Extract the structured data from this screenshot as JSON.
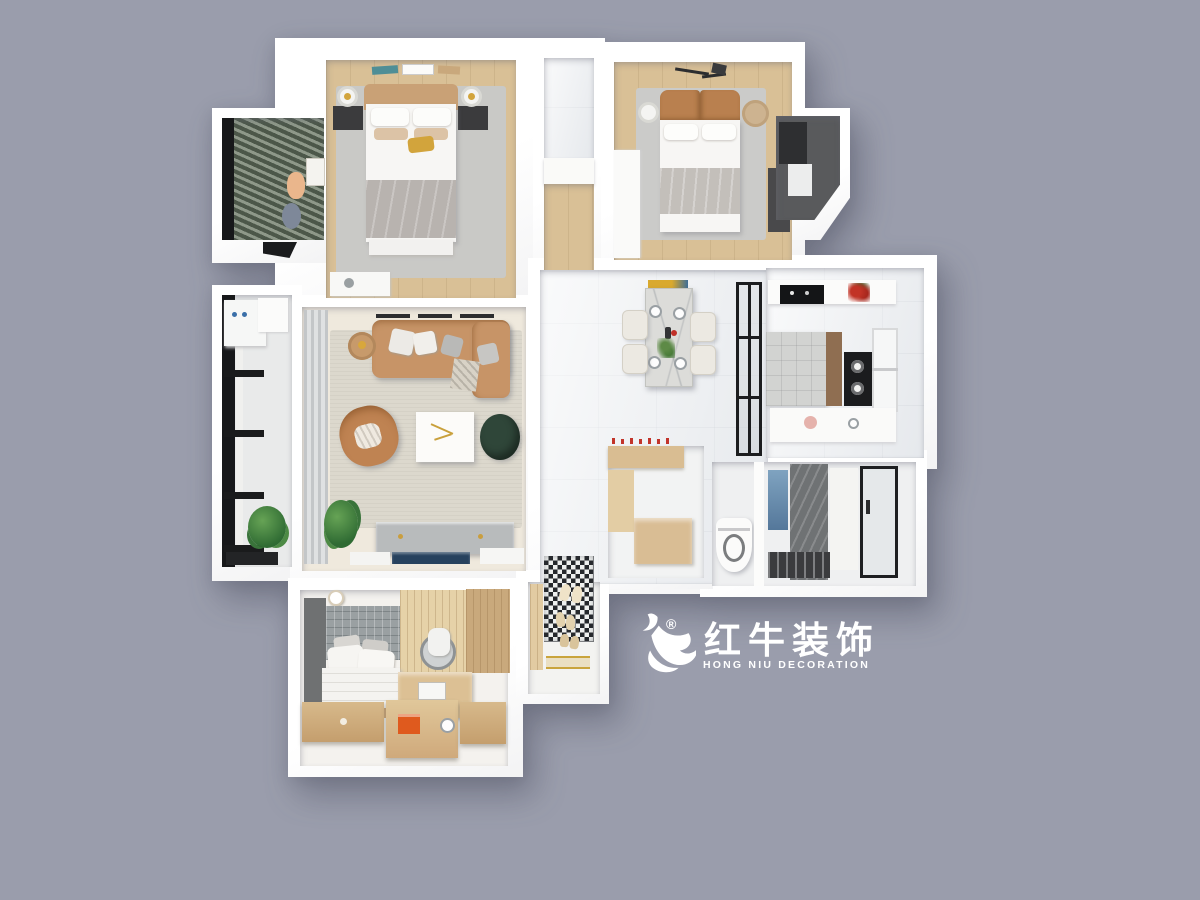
{
  "scene": {
    "type": "3d-floor-plan-top-view",
    "description": "Dollhouse top-down render of a three-bedroom apartment on a gray background"
  },
  "watermark": {
    "icon": "bull-swoosh-icon",
    "registered_symbol": "®",
    "brand_cn": "红牛装饰",
    "brand_en": "HONG NIU DECORATION",
    "color": "#ffffff"
  },
  "rooms": [
    "master-bedroom",
    "walk-in-nook",
    "corridor-closet",
    "second-bedroom",
    "service-balcony",
    "left-balcony",
    "living-room",
    "dining-hall",
    "kitchen",
    "utility-bath",
    "toilet-room",
    "shower-room",
    "third-bedroom",
    "entry-hall"
  ],
  "palette": {
    "background": "#9a9dac",
    "walls": "#ffffff",
    "wood_floor": "#d9c096",
    "rug_gray": "#c9c9c6",
    "rug_beige": "#dcd8cd",
    "marble": "#f0f2f4",
    "leather_tan": "#c79467",
    "headboard_brown": "#b9804f",
    "blanket_gray": "#b8b3af",
    "ottoman_green": "#2f4639",
    "blinds_teal": "#64705f",
    "balcony_dark": "#595a5c",
    "window_black": "#17181a",
    "mosaic_black": "#25282c",
    "cabinet_wood": "#cfa87a",
    "accent_gold": "#d2a43c",
    "accent_orange": "#df5a1e",
    "accent_red": "#c23326",
    "accent_blue": "#3f6e96",
    "plant_green": "#3f7a40"
  }
}
